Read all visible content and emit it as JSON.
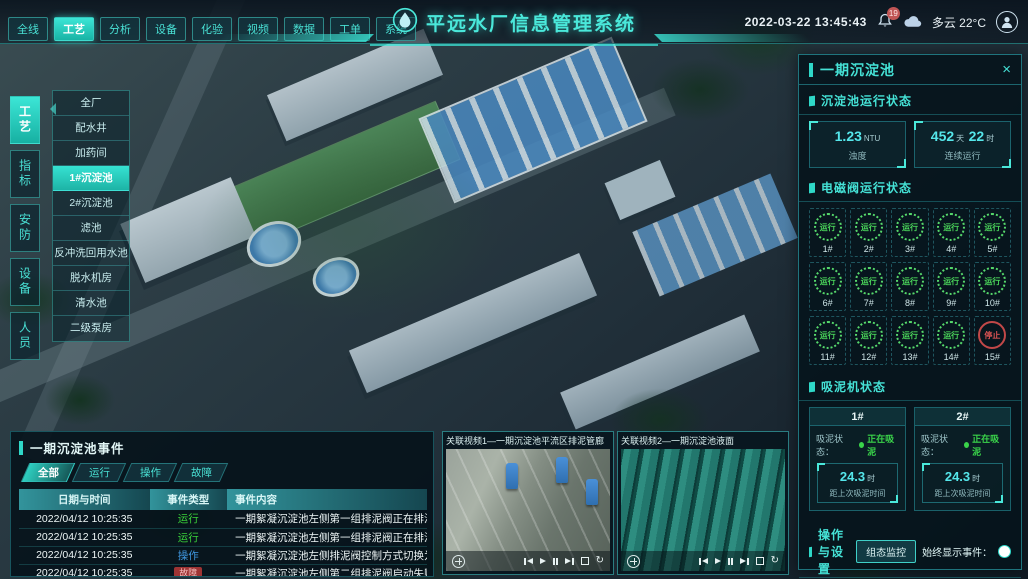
{
  "colors": {
    "accent": "#2fd8c8",
    "cyan_value": "#55e6ea",
    "green": "#3ad44a",
    "red": "#cf4444",
    "blue": "#3f97e0"
  },
  "top_bar": {
    "tabs": [
      {
        "label": "全线"
      },
      {
        "label": "工艺"
      },
      {
        "label": "分析"
      },
      {
        "label": "设备"
      },
      {
        "label": "化验"
      },
      {
        "label": "视频"
      },
      {
        "label": "数据"
      },
      {
        "label": "工单"
      },
      {
        "label": "系统"
      }
    ],
    "active_tab": "工艺",
    "title": "平远水厂信息管理系统",
    "datetime": "2022-03-22 13:45:43",
    "notification_badge": "19",
    "weather": "多云 22°C"
  },
  "left_nav": {
    "tabs": [
      {
        "label": "工艺"
      },
      {
        "label": "指标"
      },
      {
        "label": "安防"
      },
      {
        "label": "设备"
      },
      {
        "label": "人员"
      }
    ],
    "active_tab": "工艺",
    "menu_items": [
      {
        "label": "全厂"
      },
      {
        "label": "配水井"
      },
      {
        "label": "加药间"
      },
      {
        "label": "1#沉淀池"
      },
      {
        "label": "2#沉淀池"
      },
      {
        "label": "滤池"
      },
      {
        "label": "反冲洗回用水池"
      },
      {
        "label": "脱水机房"
      },
      {
        "label": "清水池"
      },
      {
        "label": "二级泵房"
      }
    ],
    "active_item": "1#沉淀池"
  },
  "right_panel": {
    "title": "一期沉淀池",
    "run_status": {
      "heading": "沉淀池运行状态",
      "stats": [
        {
          "value": "1.23",
          "unit": "NTU",
          "label": "浊度"
        },
        {
          "value": "452",
          "unit": "天",
          "value2": "22",
          "unit2": "时",
          "label": "连续运行"
        }
      ]
    },
    "valves": {
      "heading": "电磁阀运行状态",
      "items": [
        {
          "id": "1#",
          "status": "运行"
        },
        {
          "id": "2#",
          "status": "运行"
        },
        {
          "id": "3#",
          "status": "运行"
        },
        {
          "id": "4#",
          "status": "运行"
        },
        {
          "id": "5#",
          "status": "运行"
        },
        {
          "id": "6#",
          "status": "运行"
        },
        {
          "id": "7#",
          "status": "运行"
        },
        {
          "id": "8#",
          "status": "运行"
        },
        {
          "id": "9#",
          "status": "运行"
        },
        {
          "id": "10#",
          "status": "运行"
        },
        {
          "id": "11#",
          "status": "运行"
        },
        {
          "id": "12#",
          "status": "运行"
        },
        {
          "id": "13#",
          "status": "运行"
        },
        {
          "id": "14#",
          "status": "运行"
        },
        {
          "id": "15#",
          "status": "停止"
        }
      ]
    },
    "mud_pumps": {
      "heading": "吸泥机状态",
      "status_label": "吸泥状态：",
      "cards": [
        {
          "id": "1#",
          "status": "正在吸泥",
          "value": "24.3",
          "unit": "时",
          "label": "距上次吸泥时间"
        },
        {
          "id": "2#",
          "status": "正在吸泥",
          "value": "24.3",
          "unit": "时",
          "label": "距上次吸泥时间"
        }
      ]
    },
    "settings": {
      "heading": "操作与设置",
      "button": "组态监控",
      "toggle_label": "始终显示事件：",
      "toggle_on": true
    }
  },
  "events_panel": {
    "title": "一期沉淀池事件",
    "tabs": [
      {
        "label": "全部"
      },
      {
        "label": "运行"
      },
      {
        "label": "操作"
      },
      {
        "label": "故障"
      }
    ],
    "active_tab": "全部",
    "columns": [
      "日期与时间",
      "事件类型",
      "事件内容"
    ],
    "rows": [
      {
        "time": "2022/04/12 10:25:35",
        "type": "运行",
        "content": "一期絮凝沉淀池左侧第一组排泥阀正在排泥"
      },
      {
        "time": "2022/04/12 10:25:35",
        "type": "运行",
        "content": "一期絮凝沉淀池左侧第一组排泥阀正在排泥"
      },
      {
        "time": "2022/04/12 10:25:35",
        "type": "操作",
        "content": "一期絮凝沉淀池左侧排泥阀控制方式切换为手动"
      },
      {
        "time": "2022/04/12 10:25:35",
        "type": "故障",
        "content": "一期絮凝沉淀池左侧第二组排泥阀启动失败"
      }
    ]
  },
  "videos": [
    {
      "title": "关联视频1—一期沉淀池平流区排泥管廊"
    },
    {
      "title": "关联视频2—一期沉淀池液面"
    }
  ],
  "icons": {
    "close": "×",
    "loop_glyph": "↻",
    "logo": "water-drop",
    "bell": "notification-bell",
    "cloud": "weather-cloud",
    "avatar": "user",
    "media": [
      "skip-back",
      "play",
      "pause",
      "skip-forward",
      "fullscreen",
      "loop"
    ]
  }
}
